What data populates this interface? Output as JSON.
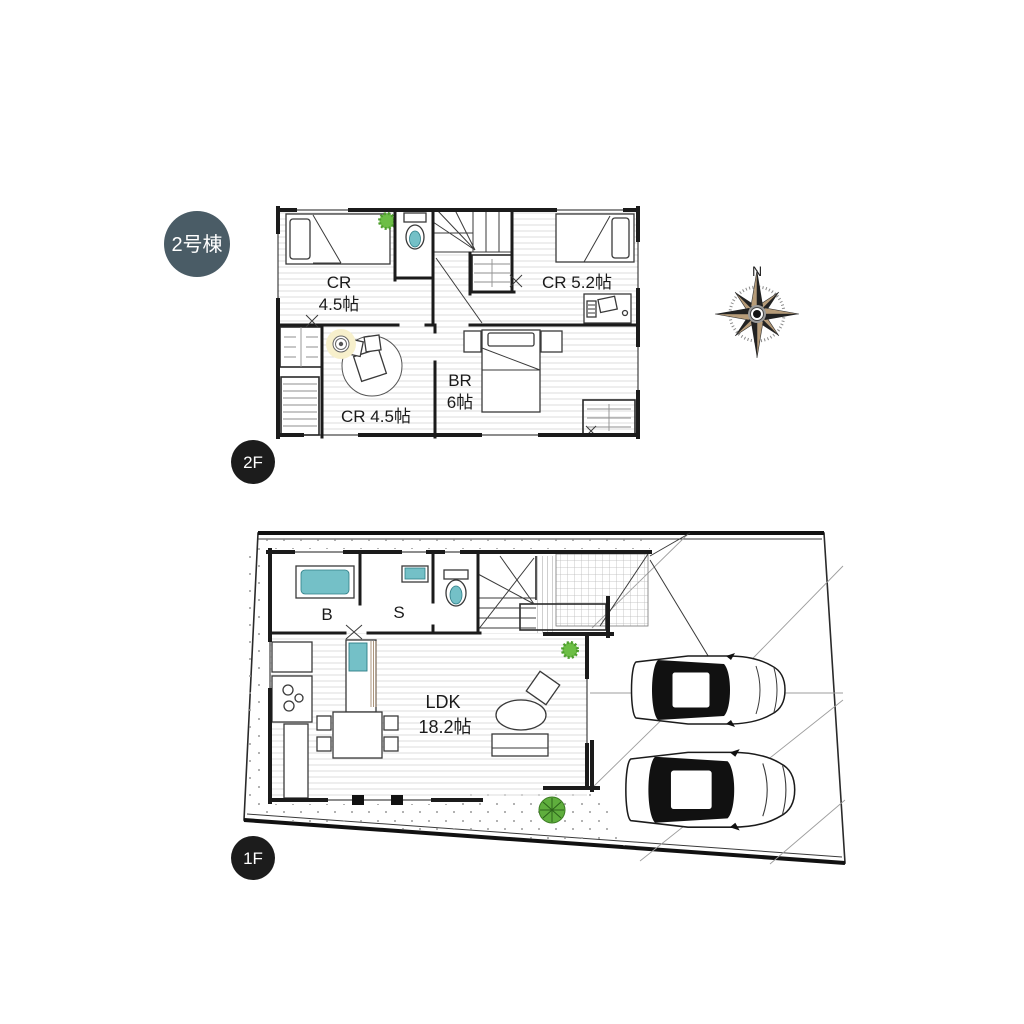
{
  "badge": {
    "label": "2号棟",
    "color": "#4a5c66"
  },
  "floor2": {
    "label": "2F",
    "rooms": {
      "cr_top": {
        "line1": "CR",
        "line2": "4.5帖"
      },
      "cr_right": {
        "name": "CR 5.2帖"
      },
      "br": {
        "line1": "BR",
        "line2": "6帖"
      },
      "cr_bottom": {
        "name": "CR 4.5帖"
      }
    }
  },
  "floor1": {
    "label": "1F",
    "rooms": {
      "bath": {
        "name": "B"
      },
      "sanitary": {
        "name": "S"
      },
      "ldk": {
        "line1": "LDK",
        "line2": "18.2帖"
      }
    }
  },
  "compass": {
    "north_label": "N"
  },
  "colors": {
    "badge": "#4a5c66",
    "fixture_teal": "#74c0c7",
    "plant_green": "#6cbe45",
    "shrub_green": "#5fae3d",
    "wall_black": "#1b1b1b",
    "compass_tan": "#b79c79",
    "compass_dark": "#222222",
    "floor_line": "#d9d9d9"
  }
}
